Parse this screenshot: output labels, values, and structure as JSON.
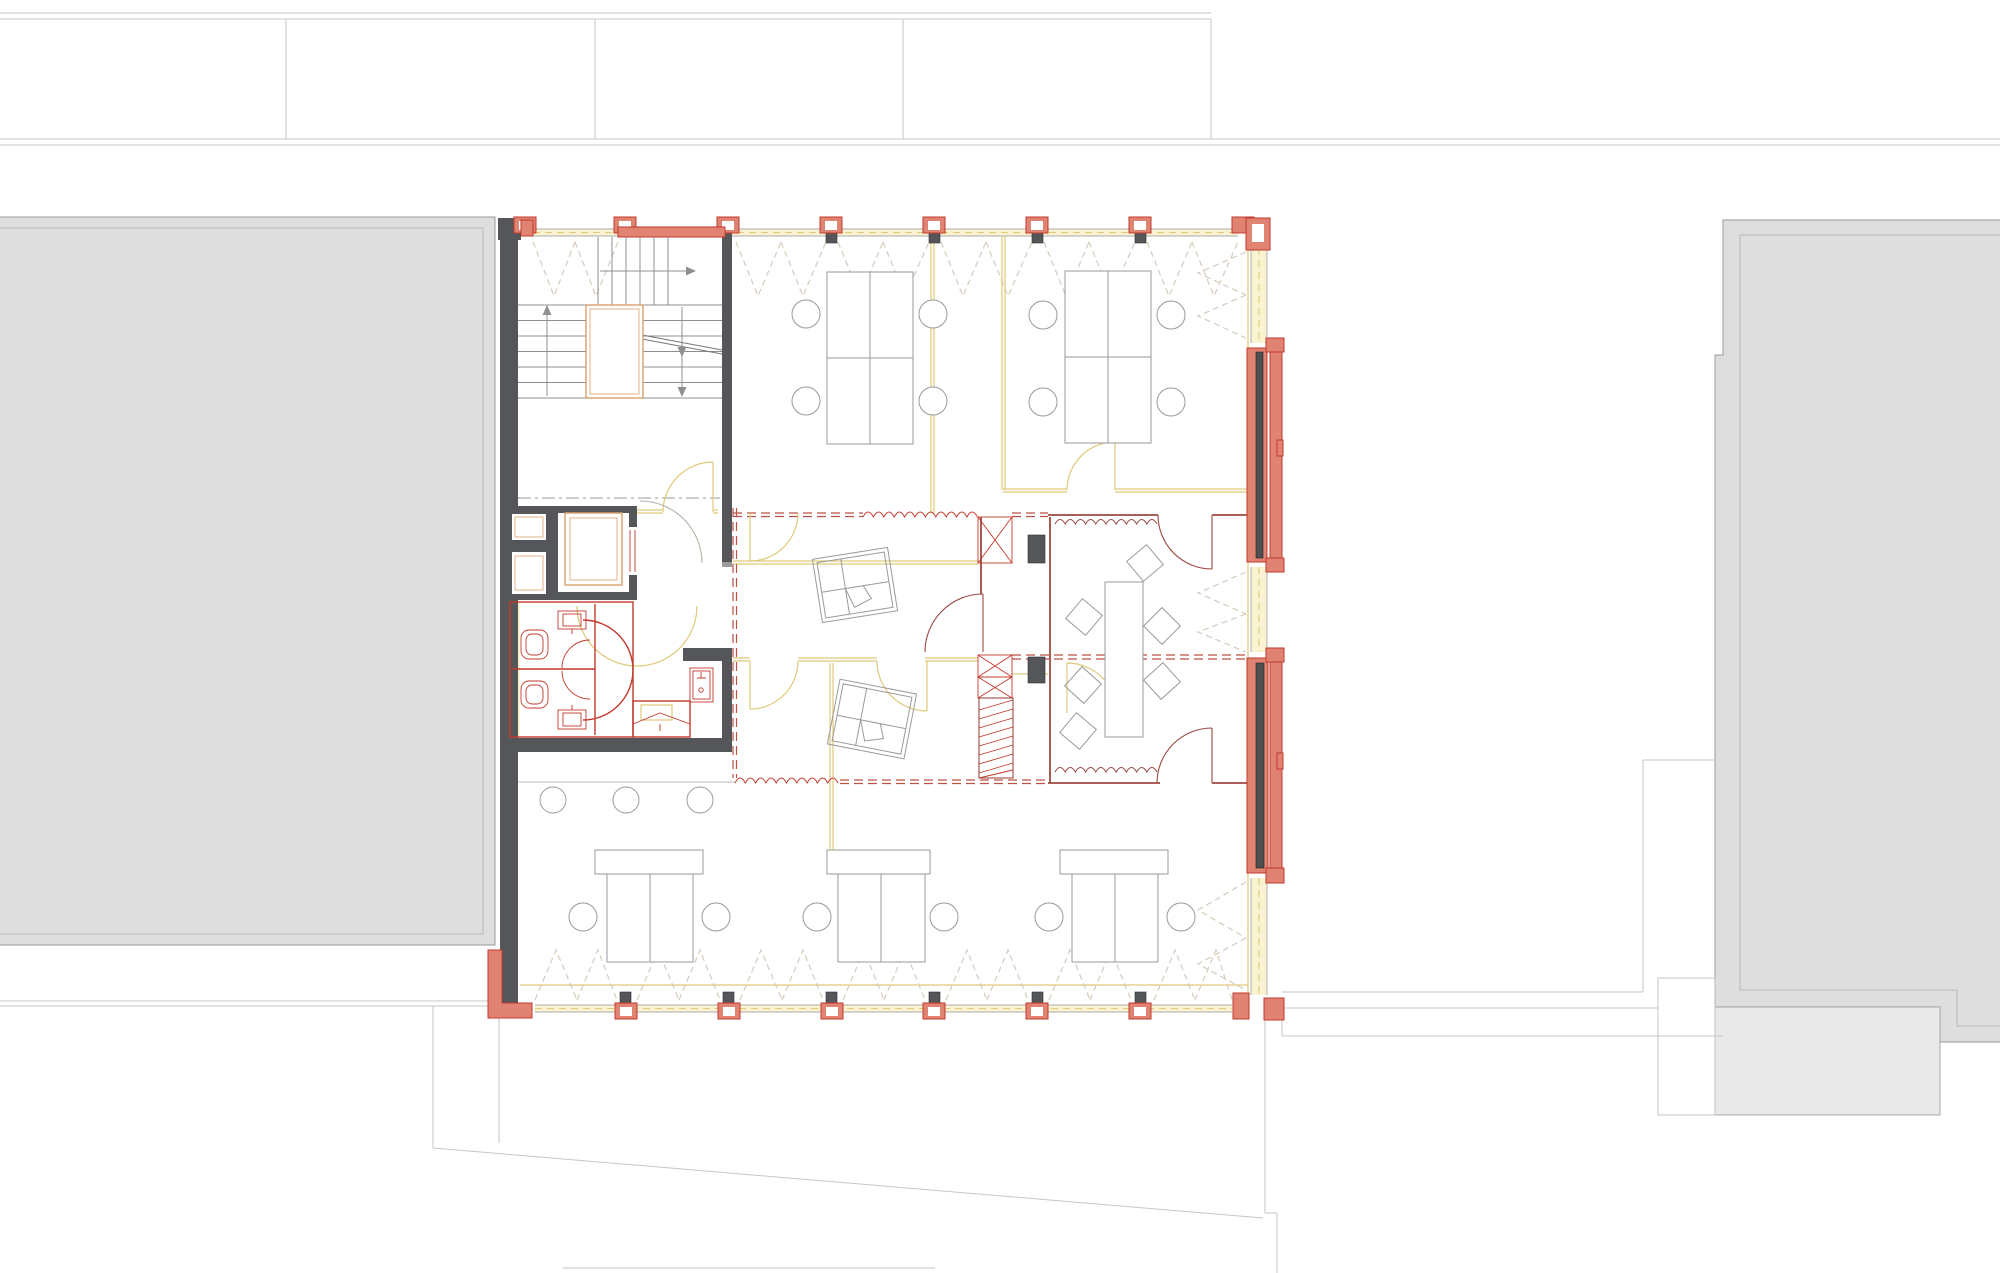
{
  "document": {
    "kind": "architectural-floor-plan",
    "view": "office-level plan with neighbouring context buildings",
    "visible_text": []
  },
  "colors": {
    "site": "#c6c6c6",
    "bldg": "#dedede",
    "bldg_line": "#a9a9a9",
    "bldg_line2": "#b8b8b8",
    "porch": "#e9e9e9",
    "wall": "#55565a",
    "salmon": "#e08372",
    "red": "#c2392c",
    "darkred": "#9c4a42",
    "dashred": "#bb5246",
    "yellow": "#dfc97a",
    "pale": "#faf3d2",
    "tan": "#d9a06b",
    "furn": "#9a9a9a",
    "glass": "#ababab",
    "lightdash": "#d6cbba",
    "dashdot": "#9a9a9a",
    "bar": "#4f4f4f",
    "greydoor": "#b9b2a6",
    "stair": "#8f8f8f"
  },
  "plan": {
    "context": [
      "street-parcels-band-top",
      "neighbour-building-left",
      "neighbour-building-right",
      "parcel-boundary-diagonal"
    ],
    "core": [
      "stair-two-flights-with-landing",
      "elevator-shaft",
      "service-ducts",
      "wc-block-two-toilets",
      "kitchenette"
    ],
    "facade": {
      "mullions_top": 8,
      "mullions_bottom": 7,
      "balconies_right": 2,
      "fire_compartment_dashed_lines": true
    },
    "furniture": {
      "double_desks_top": 2,
      "desk_groups_bottom": 3,
      "tilted_desk_groups": 2,
      "long_desk_right_rooms": 1,
      "round_chairs": 17,
      "tilted_square_chairs": 6
    }
  }
}
